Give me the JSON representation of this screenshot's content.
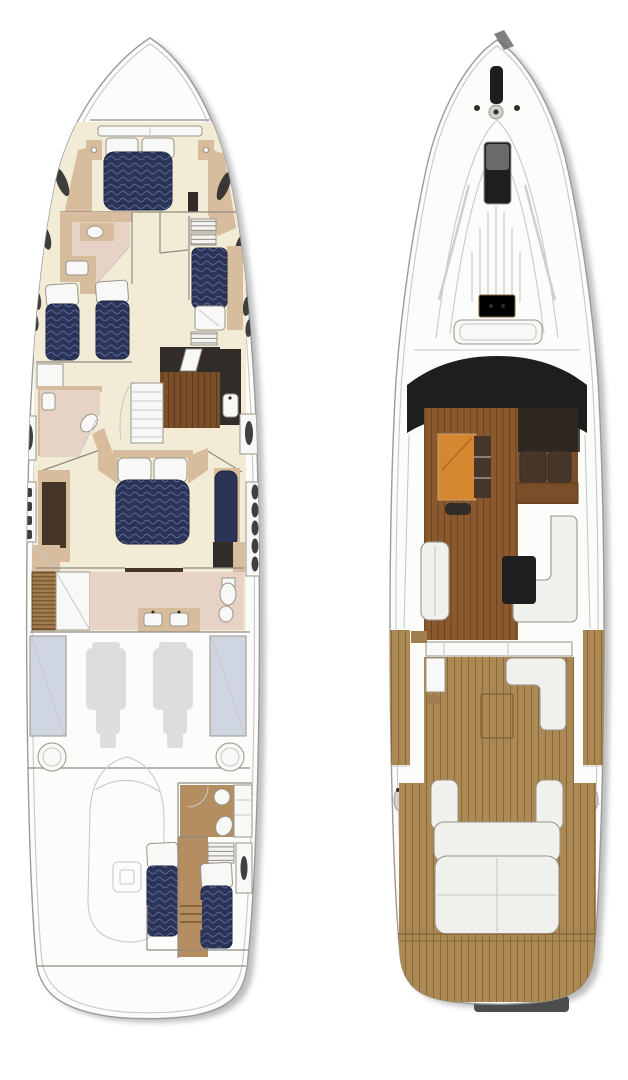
{
  "page": {
    "description": "motor-yacht deck plan drawing, two top-down views side by side, no text labels",
    "background": "#ffffff"
  },
  "colors": {
    "background": "#ffffff",
    "hull": "#fcfcfa",
    "hull_line": "#9b9b9b",
    "inner_line": "#c9c9c6",
    "shadow": "#7f7f7f",
    "line": "#8f8b84",
    "cream": "#f2ecd6",
    "tan": "#d7bd9e",
    "tan_dark": "#c2a077",
    "pink": "#e7d3c6",
    "navy": "#2b3457",
    "navy_hi": "#50608f",
    "white_obj": "#f8f8f6",
    "obj_line": "#9a958b",
    "wood_floor": "#7a4e28",
    "wood_line": "#5c3a1e",
    "wardrobe": "#a07c4e",
    "wardrobe_line": "#6b4a24",
    "crew_floor": "#b48e60",
    "dark": "#322d28",
    "dark_brown": "#46362a",
    "glass": "#1e1e1e",
    "engine": "#dcdcdc",
    "tank": "#cfd6e2",
    "teak": "#ac8852",
    "teak_line": "#86683c",
    "salon_wood": "#8a5a2e",
    "salon_wood_line": "#6b4220",
    "orange": "#d5882f",
    "settee": "#f0f0ec",
    "gray_band": "#cfcfcf",
    "trim_dark": "#4c4c4c"
  },
  "views": [
    {
      "id": "lower-deck-plan",
      "position": "left",
      "features": [
        "anchor-locker",
        "v-berth-cabin",
        "forward-head",
        "twin-berth-cabin",
        "bunk-cabin",
        "stairs",
        "galley",
        "mid-head",
        "master-cabin",
        "master-bathroom",
        "engine-room",
        "tender-stowage",
        "crew-cabin",
        "crew-head",
        "swim-platform",
        "hull-windows",
        "portholes"
      ]
    },
    {
      "id": "main-deck-plan",
      "position": "right",
      "features": [
        "anchor-windlass",
        "foredeck-hatch",
        "foredeck-planks",
        "grab-rails",
        "deck-box",
        "coachroof-hatch",
        "windshield",
        "dinette",
        "helm-seats",
        "helm-console",
        "salon-settee",
        "salon-table",
        "cockpit",
        "wet-bar",
        "cockpit-seat",
        "cockpit-table",
        "side-decks",
        "aft-sunpad",
        "swim-platform",
        "stern-trim"
      ]
    }
  ]
}
